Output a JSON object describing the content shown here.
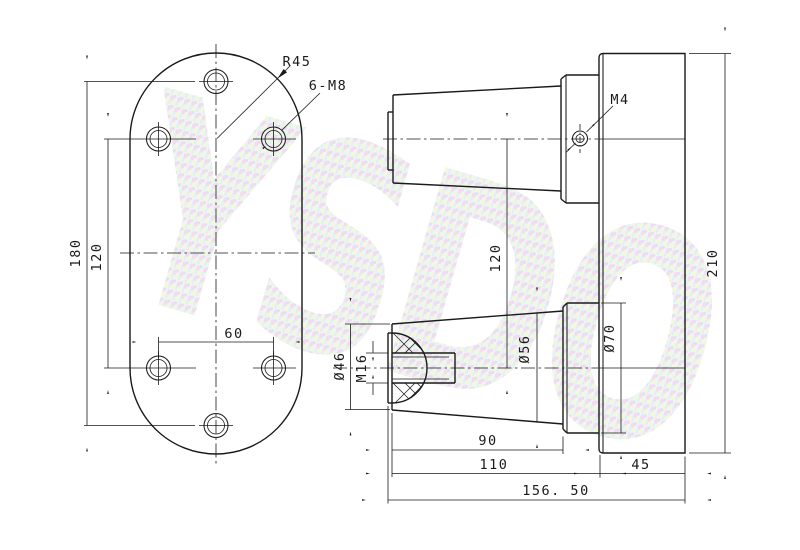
{
  "watermark": {
    "text": "YSDO"
  },
  "colors": {
    "line": "#1a1a1a",
    "bg": "#ffffff",
    "wm-base": "#d9f2ea",
    "wm-pink": "#efb9de",
    "wm-yellow": "#f2efb4",
    "wm-blue": "#c2e6f2",
    "wm-lav": "#cfc0ee"
  },
  "front_view": {
    "radius": "R45",
    "holes": "6-M8",
    "height": "180",
    "hole_span_vertical": "120",
    "hole_span_horizontal": "60"
  },
  "side_view": {
    "set_screw_thread": "M4",
    "plate_height": "210",
    "shaft_center_distance": "120",
    "ball_diameter": "Ø46",
    "ball_thread": "M16",
    "cone_diameter": "Ø56",
    "boss_diameter": "Ø70",
    "cone_length": "90",
    "body_length": "110",
    "plate_thickness": "45",
    "overall_length": "156. 50"
  }
}
